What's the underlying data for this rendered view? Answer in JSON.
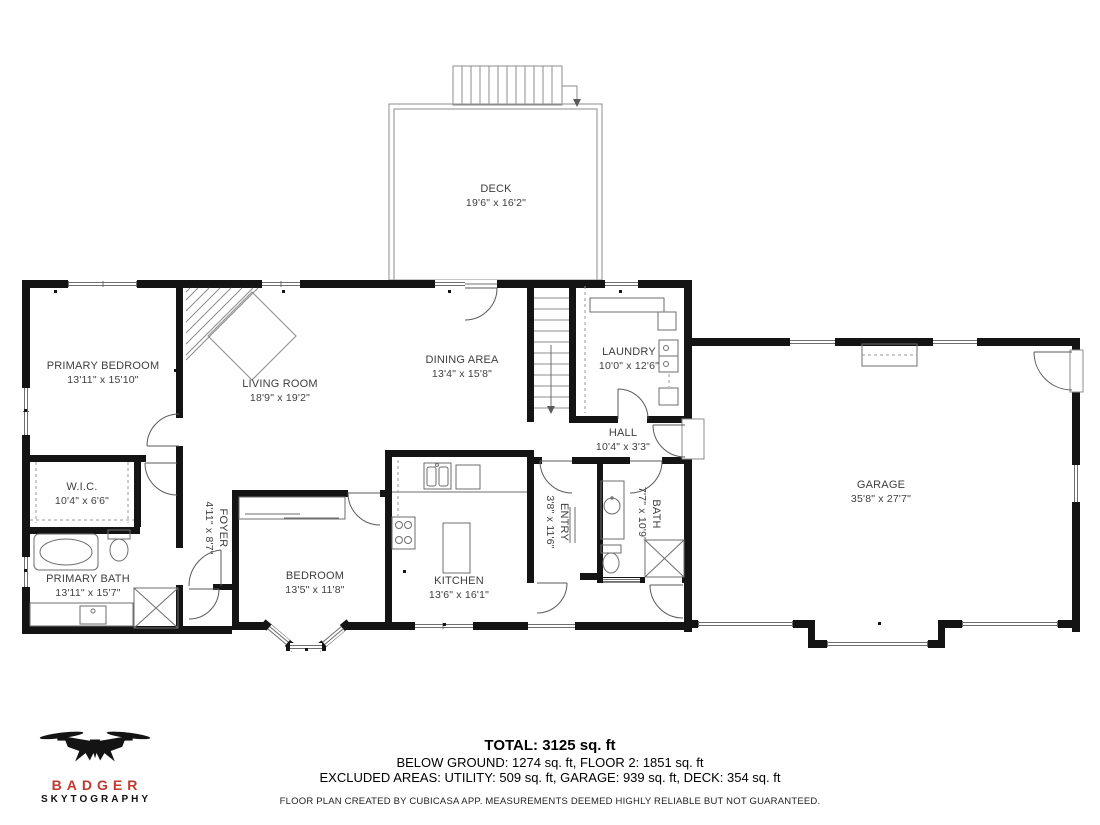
{
  "colors": {
    "wall": "#141414",
    "thin_line": "#8c8c8c",
    "fixture_line": "#6e6e6e",
    "label_text": "#3e3e3e",
    "brand_red": "#be3a30",
    "footer_text": "#000000"
  },
  "rooms": {
    "deck": {
      "name": "DECK",
      "dims": "19'6\" x 16'2\""
    },
    "primary_bedroom": {
      "name": "PRIMARY BEDROOM",
      "dims": "13'11\" x 15'10\""
    },
    "living_room": {
      "name": "LIVING ROOM",
      "dims": "18'9\" x 19'2\""
    },
    "dining_area": {
      "name": "DINING AREA",
      "dims": "13'4\" x 15'8\""
    },
    "laundry": {
      "name": "LAUNDRY",
      "dims": "10'0\" x 12'6\""
    },
    "hall": {
      "name": "HALL",
      "dims": "10'4\" x 3'3\""
    },
    "garage": {
      "name": "GARAGE",
      "dims": "35'8\" x 27'7\""
    },
    "wic": {
      "name": "W.I.C.",
      "dims": "10'4\" x 6'6\""
    },
    "primary_bath": {
      "name": "PRIMARY BATH",
      "dims": "13'11\" x 15'7\""
    },
    "foyer": {
      "name": "FOYER",
      "dims": "4'11\" x 8'7\""
    },
    "bedroom": {
      "name": "BEDROOM",
      "dims": "13'5\" x 11'8\""
    },
    "kitchen": {
      "name": "KITCHEN",
      "dims": "13'6\" x 16'1\""
    },
    "entry": {
      "name": "ENTRY",
      "dims": "3'8\" x 11'6\""
    },
    "bath": {
      "name": "BATH",
      "dims": "7'7\" x 10'9\""
    }
  },
  "summary": {
    "total": "TOTAL: 3125 sq. ft",
    "line2": "BELOW GROUND: 1274 sq. ft, FLOOR 2: 1851 sq. ft",
    "line3": "EXCLUDED AREAS: UTILITY: 509 sq. ft, GARAGE: 939 sq. ft, DECK: 354 sq. ft",
    "disclaimer": "FLOOR PLAN CREATED BY CUBICASA APP. MEASUREMENTS DEEMED HIGHLY RELIABLE BUT NOT GUARANTEED."
  },
  "logo": {
    "brand": "BADGER",
    "subbrand": "SKYTOGRAPHY"
  }
}
